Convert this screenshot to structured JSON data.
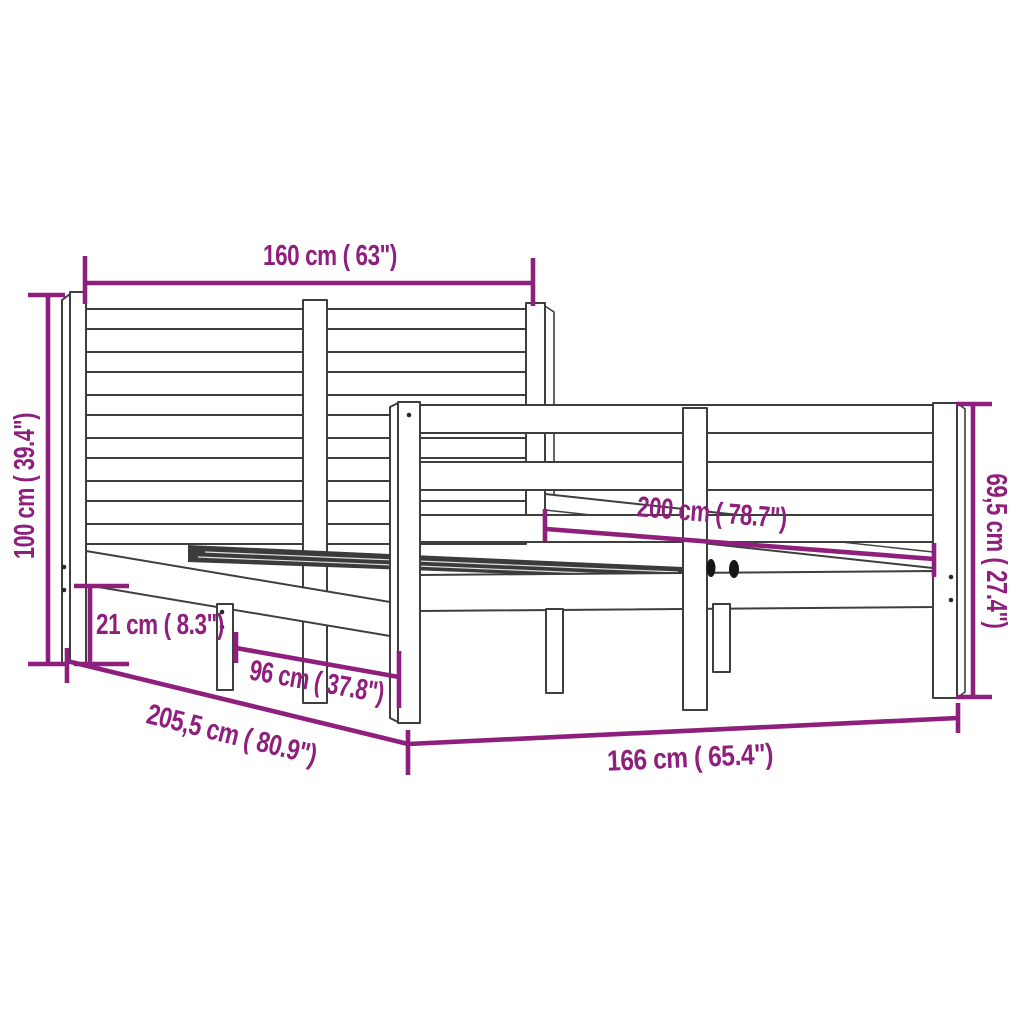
{
  "meta": {
    "background_color": "#ffffff",
    "drawing_line_color": "#3e3e3e",
    "dimension_color": "#8e1f7c",
    "object": "wooden bed frame with headboard and footboard"
  },
  "diagram": {
    "dimensions": [
      {
        "id": "headboard-width",
        "label": "160 cm ( 63\")",
        "orientation": "horizontal-top"
      },
      {
        "id": "headboard-height",
        "label": "100 cm ( 39.4\")",
        "orientation": "vertical-left"
      },
      {
        "id": "underbed-clearance",
        "label": "21 cm ( 8.3\")",
        "orientation": "vertical-left-small"
      },
      {
        "id": "leg-spacing",
        "label": "96 cm ( 37.8\")",
        "orientation": "diagonal-front-left"
      },
      {
        "id": "total-length",
        "label": "205,5 cm ( 80.9\")",
        "orientation": "diagonal-bottom-left"
      },
      {
        "id": "frame-width",
        "label": "166 cm ( 65.4\")",
        "orientation": "horizontal-bottom"
      },
      {
        "id": "mattress-length",
        "label": "200 cm ( 78.7\")",
        "orientation": "diagonal-middle"
      },
      {
        "id": "footboard-height",
        "label": "69,5 cm ( 27.4\")",
        "orientation": "vertical-right"
      }
    ]
  }
}
